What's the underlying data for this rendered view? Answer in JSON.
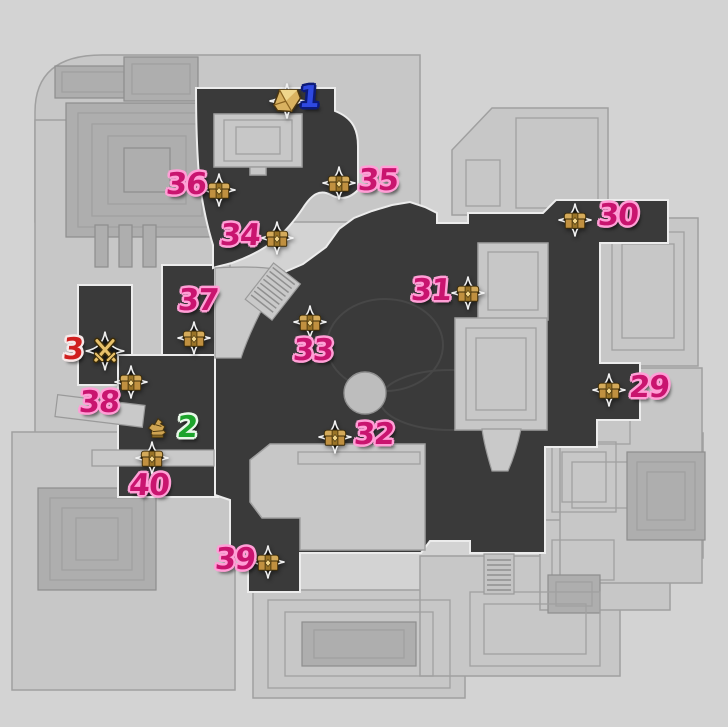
{
  "map": {
    "background": "#d3d3d3",
    "terrain": "#3a3a3a",
    "terrain_edge": "#ececec",
    "building": "#c7c7c7",
    "building_stroke": "#a0a0a0",
    "detail": "#aeaeae"
  },
  "palette": {
    "pink": {
      "fill": "#c9146f",
      "outline": "#ff9fd6"
    },
    "blue": {
      "fill": "#2f49e1",
      "outline": "#0c1a78"
    },
    "green": {
      "fill": "#1da42c",
      "outline": "#e9f8e9"
    },
    "red": {
      "fill": "#d01f1f",
      "outline": "#f6e9e9"
    }
  },
  "markers": [
    {
      "label": "1",
      "color": "blue",
      "icon": "treasure",
      "icon_x": 287,
      "icon_y": 101,
      "label_x": 309,
      "label_y": 99
    },
    {
      "label": "2",
      "color": "green",
      "icon": "relic",
      "icon_x": 158,
      "icon_y": 429,
      "label_x": 187,
      "label_y": 429
    },
    {
      "label": "3",
      "color": "red",
      "icon": "battle",
      "icon_x": 105,
      "icon_y": 351,
      "label_x": 73,
      "label_y": 351
    },
    {
      "label": "29",
      "color": "pink",
      "icon": "chest",
      "icon_x": 609,
      "icon_y": 390,
      "label_x": 649,
      "label_y": 389
    },
    {
      "label": "30",
      "color": "pink",
      "icon": "chest",
      "icon_x": 575,
      "icon_y": 220,
      "label_x": 618,
      "label_y": 217
    },
    {
      "label": "31",
      "color": "pink",
      "icon": "chest",
      "icon_x": 468,
      "icon_y": 293,
      "label_x": 431,
      "label_y": 292
    },
    {
      "label": "32",
      "color": "pink",
      "icon": "chest",
      "icon_x": 335,
      "icon_y": 437,
      "label_x": 374,
      "label_y": 436
    },
    {
      "label": "33",
      "color": "pink",
      "icon": "chest",
      "icon_x": 310,
      "icon_y": 322,
      "label_x": 313,
      "label_y": 352
    },
    {
      "label": "34",
      "color": "pink",
      "icon": "chest",
      "icon_x": 277,
      "icon_y": 238,
      "label_x": 240,
      "label_y": 237
    },
    {
      "label": "35",
      "color": "pink",
      "icon": "chest",
      "icon_x": 339,
      "icon_y": 183,
      "label_x": 378,
      "label_y": 182
    },
    {
      "label": "36",
      "color": "pink",
      "icon": "chest",
      "icon_x": 219,
      "icon_y": 190,
      "label_x": 186,
      "label_y": 186
    },
    {
      "label": "37",
      "color": "pink",
      "icon": "chest",
      "icon_x": 194,
      "icon_y": 338,
      "label_x": 198,
      "label_y": 302
    },
    {
      "label": "38",
      "color": "pink",
      "icon": "chest",
      "icon_x": 131,
      "icon_y": 382,
      "label_x": 99,
      "label_y": 404
    },
    {
      "label": "39",
      "color": "pink",
      "icon": "chest",
      "icon_x": 268,
      "icon_y": 562,
      "label_x": 235,
      "label_y": 561
    },
    {
      "label": "40",
      "color": "pink",
      "icon": "chest",
      "icon_x": 152,
      "icon_y": 458,
      "label_x": 149,
      "label_y": 487
    }
  ]
}
